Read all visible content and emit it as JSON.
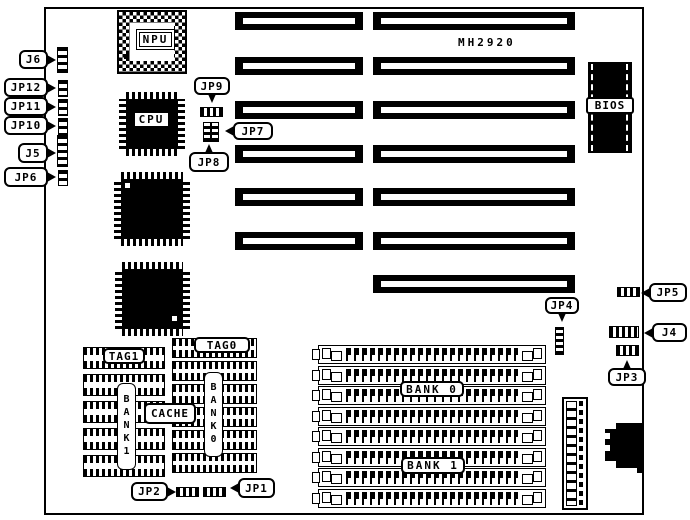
{
  "board": {
    "model": "MH2920"
  },
  "chips": {
    "npu": "NPU",
    "cpu": "CPU",
    "bios": "BIOS"
  },
  "callouts": {
    "j6": "J6",
    "jp12": "JP12",
    "jp11": "JP11",
    "jp10": "JP10",
    "j5": "J5",
    "jp6": "JP6",
    "jp9": "JP9",
    "jp7": "JP7",
    "jp8": "JP8",
    "jp4": "JP4",
    "jp5": "JP5",
    "j4": "J4",
    "jp3": "JP3",
    "jp2": "JP2",
    "jp1": "JP1"
  },
  "cache": {
    "tag1": "TAG1",
    "tag0": "TAG0",
    "label": "CACHE",
    "bank1_vertical": "BANK1",
    "bank0_vertical": "BANK0"
  },
  "memory": {
    "bank0": "BANK 0",
    "bank1": "BANK 1"
  },
  "colors": {
    "ink": "#000000",
    "paper": "#ffffff"
  }
}
